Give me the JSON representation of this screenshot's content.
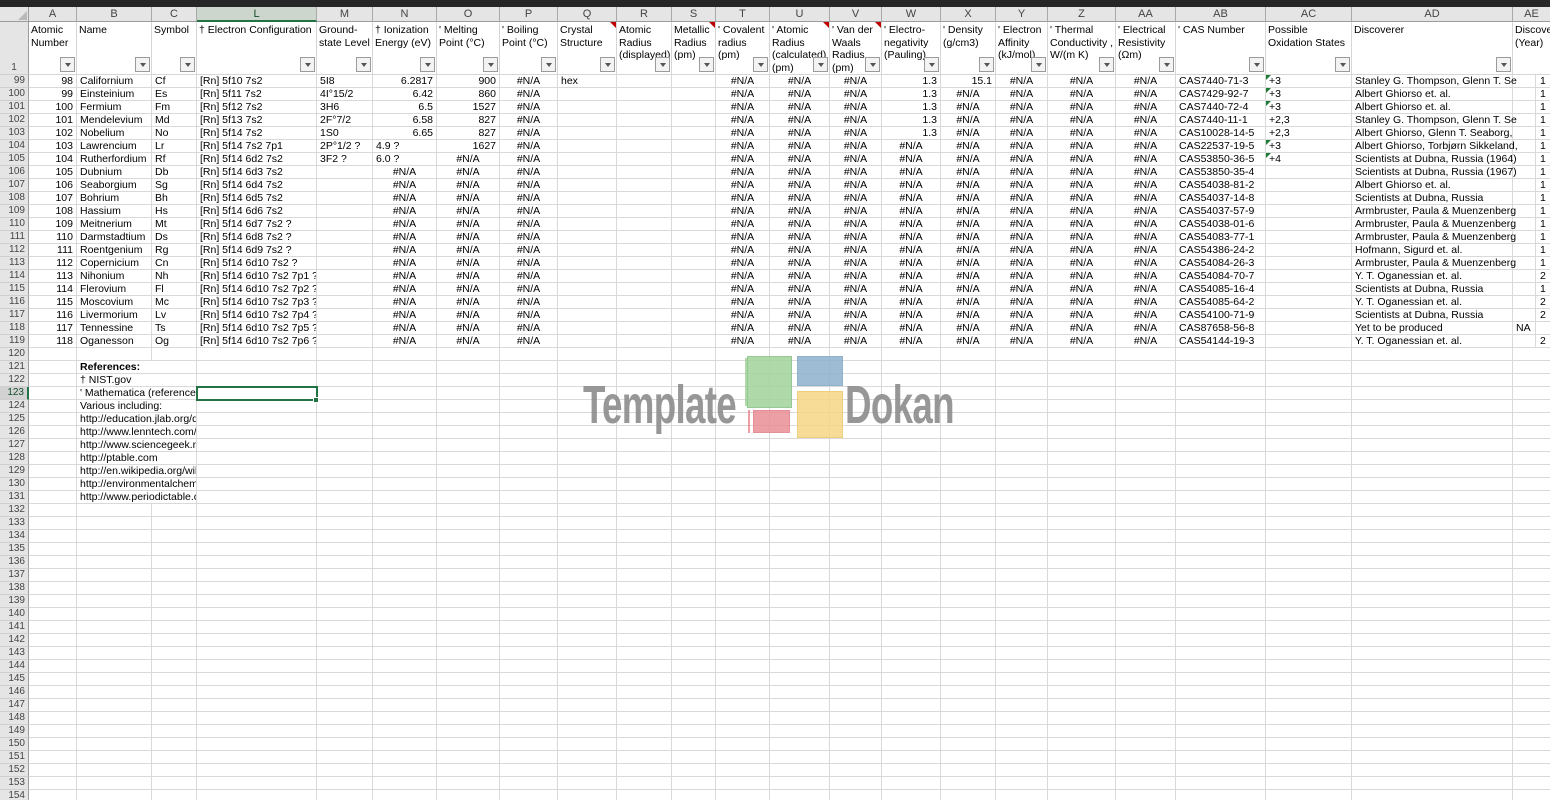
{
  "selection": {
    "cell": "L123",
    "row": 123,
    "col": "L",
    "accent_color": "#217346"
  },
  "sheet": {
    "first_data_row": 99,
    "last_visible_row": 154,
    "references_start_row": 121,
    "columns": [
      {
        "letter": "A",
        "width": 48,
        "label": "Atomic Number",
        "filter": true,
        "comment": false
      },
      {
        "letter": "B",
        "width": 75,
        "label": "Name",
        "filter": true,
        "comment": false
      },
      {
        "letter": "C",
        "width": 45,
        "label": "Symbol",
        "filter": true,
        "comment": false
      },
      {
        "letter": "L",
        "width": 120,
        "label": "† Electron Configuration",
        "filter": true,
        "comment": false
      },
      {
        "letter": "M",
        "width": 56,
        "label": "Ground-state Level",
        "filter": true,
        "comment": false
      },
      {
        "letter": "N",
        "width": 64,
        "label": "† Ionization Energy (eV)",
        "filter": true,
        "comment": false
      },
      {
        "letter": "O",
        "width": 63,
        "label": "' Melting Point (°C)",
        "filter": true,
        "comment": false
      },
      {
        "letter": "P",
        "width": 58,
        "label": "' Boiling Point (°C)",
        "filter": true,
        "comment": false
      },
      {
        "letter": "Q",
        "width": 59,
        "label": "Crystal Structure",
        "filter": true,
        "comment": true
      },
      {
        "letter": "R",
        "width": 55,
        "label": "Atomic Radius (displayed)",
        "filter": true,
        "comment": false
      },
      {
        "letter": "S",
        "width": 44,
        "label": "Metallic Radius (pm)",
        "filter": true,
        "comment": true
      },
      {
        "letter": "T",
        "width": 54,
        "label": "' Covalent radius (pm)",
        "filter": true,
        "comment": false
      },
      {
        "letter": "U",
        "width": 60,
        "label": "' Atomic Radius (calculated) (pm)",
        "filter": true,
        "comment": true
      },
      {
        "letter": "V",
        "width": 52,
        "label": "' Van der Waals Radius (pm)",
        "filter": true,
        "comment": true
      },
      {
        "letter": "W",
        "width": 59,
        "label": "' Electro-negativity (Pauling)",
        "filter": true,
        "comment": false
      },
      {
        "letter": "X",
        "width": 55,
        "label": "' Density (g/cm3)",
        "filter": true,
        "comment": false
      },
      {
        "letter": "Y",
        "width": 52,
        "label": "' Electron Affinity (kJ/mol)",
        "filter": true,
        "comment": false
      },
      {
        "letter": "Z",
        "width": 68,
        "label": "' Thermal Conductivity , W/(m K)",
        "filter": true,
        "comment": false
      },
      {
        "letter": "AA",
        "width": 60,
        "label": "' Electrical Resistivity (Ωm)",
        "filter": true,
        "comment": false
      },
      {
        "letter": "AB",
        "width": 90,
        "label": "' CAS Number",
        "filter": true,
        "comment": false
      },
      {
        "letter": "AC",
        "width": 86,
        "label": "Possible Oxidation States",
        "filter": true,
        "comment": false
      },
      {
        "letter": "AD",
        "width": 161,
        "label": "Discoverer",
        "filter": true,
        "comment": false
      },
      {
        "letter": "AE",
        "width": 23,
        "letter_width": 37,
        "label": "Discovery (Year)",
        "filter": false,
        "comment": false
      }
    ],
    "rows": [
      {
        "n": 99,
        "v": [
          "98",
          "Californium",
          "Cf",
          "[Rn] 5f10 7s2",
          "5I8",
          "6.2817",
          "900",
          "#N/A",
          "hex",
          "",
          "",
          "#N/A",
          "#N/A",
          "#N/A",
          "1.3",
          "15.1",
          "#N/A",
          "#N/A",
          "#N/A",
          "CAS7440-71-3",
          "+3",
          "Stanley G. Thompson, Glenn T. Se"
        ],
        "ae": "",
        "yr": "1",
        "tri": true
      },
      {
        "n": 100,
        "v": [
          "99",
          "Einsteinium",
          "Es",
          "[Rn] 5f11 7s2",
          "4I°15/2",
          "6.42",
          "860",
          "#N/A",
          "",
          "",
          "",
          "#N/A",
          "#N/A",
          "#N/A",
          "1.3",
          "#N/A",
          "#N/A",
          "#N/A",
          "#N/A",
          "CAS7429-92-7",
          "+3",
          "Albert Ghiorso et. al."
        ],
        "ae": "",
        "yr": "1",
        "tri": true
      },
      {
        "n": 101,
        "v": [
          "100",
          "Fermium",
          "Fm",
          "[Rn] 5f12 7s2",
          "3H6",
          "6.5",
          "1527",
          "#N/A",
          "",
          "",
          "",
          "#N/A",
          "#N/A",
          "#N/A",
          "1.3",
          "#N/A",
          "#N/A",
          "#N/A",
          "#N/A",
          "CAS7440-72-4",
          "+3",
          "Albert Ghiorso et. al."
        ],
        "ae": "",
        "yr": "1",
        "tri": true
      },
      {
        "n": 102,
        "v": [
          "101",
          "Mendelevium",
          "Md",
          "[Rn] 5f13 7s2",
          "2F°7/2",
          "6.58",
          "827",
          "#N/A",
          "",
          "",
          "",
          "#N/A",
          "#N/A",
          "#N/A",
          "1.3",
          "#N/A",
          "#N/A",
          "#N/A",
          "#N/A",
          "CAS7440-11-1",
          "+2,3",
          "Stanley G. Thompson, Glenn T. Se"
        ],
        "ae": "",
        "yr": "1",
        "tri": false
      },
      {
        "n": 103,
        "v": [
          "102",
          "Nobelium",
          "No",
          "[Rn] 5f14 7s2",
          "1S0",
          "6.65",
          "827",
          "#N/A",
          "",
          "",
          "",
          "#N/A",
          "#N/A",
          "#N/A",
          "1.3",
          "#N/A",
          "#N/A",
          "#N/A",
          "#N/A",
          "CAS10028-14-5",
          "+2,3",
          "Albert Ghiorso, Glenn T. Seaborg,"
        ],
        "ae": "",
        "yr": "1",
        "tri": false
      },
      {
        "n": 104,
        "v": [
          "103",
          "Lawrencium",
          "Lr",
          "[Rn] 5f14 7s2 7p1",
          "2P°1/2 ?",
          "4.9 ?",
          "1627",
          "#N/A",
          "",
          "",
          "",
          "#N/A",
          "#N/A",
          "#N/A",
          "#N/A",
          "#N/A",
          "#N/A",
          "#N/A",
          "#N/A",
          "CAS22537-19-5",
          "+3",
          "Albert Ghiorso, Torbjørn Sikkeland,"
        ],
        "ae": "",
        "yr": "1",
        "tri": true
      },
      {
        "n": 105,
        "v": [
          "104",
          "Rutherfordium",
          "Rf",
          "[Rn] 5f14 6d2 7s2",
          "3F2 ?",
          "6.0 ?",
          "#N/A",
          "#N/A",
          "",
          "",
          "",
          "#N/A",
          "#N/A",
          "#N/A",
          "#N/A",
          "#N/A",
          "#N/A",
          "#N/A",
          "#N/A",
          "CAS53850-36-5",
          "+4",
          "Scientists at Dubna, Russia (1964)"
        ],
        "ae": "",
        "yr": "1",
        "tri": true
      },
      {
        "n": 106,
        "v": [
          "105",
          "Dubnium",
          "Db",
          "[Rn] 5f14 6d3 7s2",
          "",
          "#N/A",
          "#N/A",
          "#N/A",
          "",
          "",
          "",
          "#N/A",
          "#N/A",
          "#N/A",
          "#N/A",
          "#N/A",
          "#N/A",
          "#N/A",
          "#N/A",
          "CAS53850-35-4",
          "",
          "Scientists at Dubna, Russia (1967)"
        ],
        "ae": "",
        "yr": "1",
        "tri": false
      },
      {
        "n": 107,
        "v": [
          "106",
          "Seaborgium",
          "Sg",
          "[Rn] 5f14 6d4 7s2",
          "",
          "#N/A",
          "#N/A",
          "#N/A",
          "",
          "",
          "",
          "#N/A",
          "#N/A",
          "#N/A",
          "#N/A",
          "#N/A",
          "#N/A",
          "#N/A",
          "#N/A",
          "CAS54038-81-2",
          "",
          "Albert Ghiorso et. al."
        ],
        "ae": "",
        "yr": "1",
        "tri": false
      },
      {
        "n": 108,
        "v": [
          "107",
          "Bohrium",
          "Bh",
          "[Rn] 5f14 6d5 7s2",
          "",
          "#N/A",
          "#N/A",
          "#N/A",
          "",
          "",
          "",
          "#N/A",
          "#N/A",
          "#N/A",
          "#N/A",
          "#N/A",
          "#N/A",
          "#N/A",
          "#N/A",
          "CAS54037-14-8",
          "",
          "Scientists at Dubna, Russia"
        ],
        "ae": "",
        "yr": "1",
        "tri": false
      },
      {
        "n": 109,
        "v": [
          "108",
          "Hassium",
          "Hs",
          "[Rn] 5f14 6d6 7s2",
          "",
          "#N/A",
          "#N/A",
          "#N/A",
          "",
          "",
          "",
          "#N/A",
          "#N/A",
          "#N/A",
          "#N/A",
          "#N/A",
          "#N/A",
          "#N/A",
          "#N/A",
          "CAS54037-57-9",
          "",
          "Armbruster, Paula & Muenzenberg"
        ],
        "ae": "",
        "yr": "1",
        "tri": false
      },
      {
        "n": 110,
        "v": [
          "109",
          "Meitnerium",
          "Mt",
          "[Rn] 5f14 6d7 7s2 ?",
          "",
          "#N/A",
          "#N/A",
          "#N/A",
          "",
          "",
          "",
          "#N/A",
          "#N/A",
          "#N/A",
          "#N/A",
          "#N/A",
          "#N/A",
          "#N/A",
          "#N/A",
          "CAS54038-01-6",
          "",
          "Armbruster, Paula & Muenzenberg"
        ],
        "ae": "",
        "yr": "1",
        "tri": false
      },
      {
        "n": 111,
        "v": [
          "110",
          "Darmstadtium",
          "Ds",
          "[Rn] 5f14 6d8 7s2 ?",
          "",
          "#N/A",
          "#N/A",
          "#N/A",
          "",
          "",
          "",
          "#N/A",
          "#N/A",
          "#N/A",
          "#N/A",
          "#N/A",
          "#N/A",
          "#N/A",
          "#N/A",
          "CAS54083-77-1",
          "",
          "Armbruster, Paula & Muenzenberg"
        ],
        "ae": "",
        "yr": "1",
        "tri": false
      },
      {
        "n": 112,
        "v": [
          "111",
          "Roentgenium",
          "Rg",
          "[Rn] 5f14 6d9 7s2 ?",
          "",
          "#N/A",
          "#N/A",
          "#N/A",
          "",
          "",
          "",
          "#N/A",
          "#N/A",
          "#N/A",
          "#N/A",
          "#N/A",
          "#N/A",
          "#N/A",
          "#N/A",
          "CAS54386-24-2",
          "",
          "Hofmann, Sigurd et. al."
        ],
        "ae": "",
        "yr": "1",
        "tri": false
      },
      {
        "n": 113,
        "v": [
          "112",
          "Copernicium",
          "Cn",
          "[Rn] 5f14 6d10 7s2 ?",
          "",
          "#N/A",
          "#N/A",
          "#N/A",
          "",
          "",
          "",
          "#N/A",
          "#N/A",
          "#N/A",
          "#N/A",
          "#N/A",
          "#N/A",
          "#N/A",
          "#N/A",
          "CAS54084-26-3",
          "",
          "Armbruster, Paula & Muenzenberg"
        ],
        "ae": "",
        "yr": "1",
        "tri": false
      },
      {
        "n": 114,
        "v": [
          "113",
          "Nihonium",
          "Nh",
          "[Rn] 5f14 6d10 7s2 7p1 ?",
          "",
          "#N/A",
          "#N/A",
          "#N/A",
          "",
          "",
          "",
          "#N/A",
          "#N/A",
          "#N/A",
          "#N/A",
          "#N/A",
          "#N/A",
          "#N/A",
          "#N/A",
          "CAS54084-70-7",
          "",
          "Y. T. Oganessian et. al."
        ],
        "ae": "",
        "yr": "2",
        "tri": false
      },
      {
        "n": 115,
        "v": [
          "114",
          "Flerovium",
          "Fl",
          "[Rn] 5f14 6d10 7s2 7p2 ?",
          "",
          "#N/A",
          "#N/A",
          "#N/A",
          "",
          "",
          "",
          "#N/A",
          "#N/A",
          "#N/A",
          "#N/A",
          "#N/A",
          "#N/A",
          "#N/A",
          "#N/A",
          "CAS54085-16-4",
          "",
          "Scientists at Dubna, Russia"
        ],
        "ae": "",
        "yr": "1",
        "tri": false
      },
      {
        "n": 116,
        "v": [
          "115",
          "Moscovium",
          "Mc",
          "[Rn] 5f14 6d10 7s2 7p3 ?",
          "",
          "#N/A",
          "#N/A",
          "#N/A",
          "",
          "",
          "",
          "#N/A",
          "#N/A",
          "#N/A",
          "#N/A",
          "#N/A",
          "#N/A",
          "#N/A",
          "#N/A",
          "CAS54085-64-2",
          "",
          "Y. T. Oganessian et. al."
        ],
        "ae": "",
        "yr": "2",
        "tri": false
      },
      {
        "n": 117,
        "v": [
          "116",
          "Livermorium",
          "Lv",
          "[Rn] 5f14 6d10 7s2 7p4 ?",
          "",
          "#N/A",
          "#N/A",
          "#N/A",
          "",
          "",
          "",
          "#N/A",
          "#N/A",
          "#N/A",
          "#N/A",
          "#N/A",
          "#N/A",
          "#N/A",
          "#N/A",
          "CAS54100-71-9",
          "",
          "Scientists at Dubna, Russia"
        ],
        "ae": "",
        "yr": "2",
        "tri": false
      },
      {
        "n": 118,
        "v": [
          "117",
          "Tennessine",
          "Ts",
          "[Rn] 5f14 6d10 7s2 7p5 ?",
          "",
          "#N/A",
          "#N/A",
          "#N/A",
          "",
          "",
          "",
          "#N/A",
          "#N/A",
          "#N/A",
          "#N/A",
          "#N/A",
          "#N/A",
          "#N/A",
          "#N/A",
          "CAS87658-56-8",
          "",
          "Yet to be produced"
        ],
        "ae": "NA",
        "yr": "",
        "tri": false
      },
      {
        "n": 119,
        "v": [
          "118",
          "Oganesson",
          "Og",
          "[Rn] 5f14 6d10 7s2 7p6 ?",
          "",
          "#N/A",
          "#N/A",
          "#N/A",
          "",
          "",
          "",
          "#N/A",
          "#N/A",
          "#N/A",
          "#N/A",
          "#N/A",
          "#N/A",
          "#N/A",
          "#N/A",
          "CAS54144-19-3",
          "",
          "Y. T. Oganessian et. al."
        ],
        "ae": "",
        "yr": "2",
        "tri": false
      }
    ],
    "references": [
      {
        "text": "References:",
        "bold": true
      },
      {
        "text": "† NIST.gov",
        "bold": false
      },
      {
        "text": "' Mathematica (references",
        "bold": false
      },
      {
        "text": "Various including:",
        "bold": false
      },
      {
        "text": "http://education.jlab.org/q",
        "bold": false
      },
      {
        "text": "http://www.lenntech.com/p",
        "bold": false
      },
      {
        "text": "http://www.sciencegeek.n",
        "bold": false
      },
      {
        "text": "http://ptable.com",
        "bold": false
      },
      {
        "text": "http://en.wikipedia.org/wik",
        "bold": false
      },
      {
        "text": "http://environmentalchemi",
        "bold": false
      },
      {
        "text": "http://www.periodictable.c",
        "bold": false
      }
    ]
  },
  "watermark": {
    "text_left": "Template",
    "text_right": "Dokan",
    "text_color": "#8f8f8f",
    "logo_colors": {
      "green": "#a3d39c",
      "blue": "#8fb2cd",
      "red": "#ea9096",
      "yellow": "#f5d785"
    }
  },
  "colors": {
    "gridline": "#d9d9d9",
    "header_bg": "#e5e5e5",
    "selection_green": "#217346",
    "error_indicator_green": "#1f7a33",
    "comment_indicator_red": "#c00000"
  }
}
